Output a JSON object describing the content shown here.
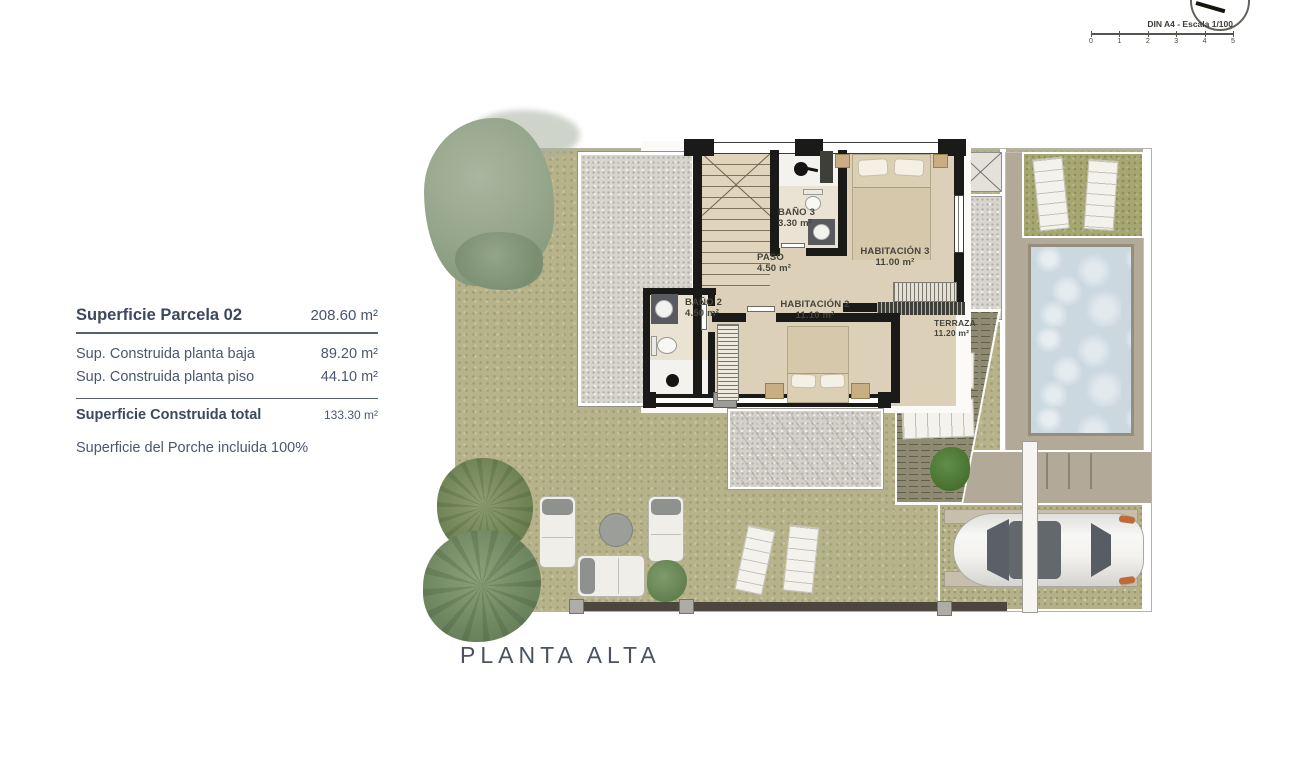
{
  "header": {
    "scale_label": "DIN A4 - Escala 1/100",
    "scale_ticks": [
      "0",
      "1",
      "2",
      "3",
      "4",
      "5"
    ]
  },
  "info_panel": {
    "title": {
      "label": "Superficie Parcela 02",
      "value": "208.60 m²"
    },
    "rows": [
      {
        "label": "Sup. Construida planta baja",
        "value": "89.20 m²"
      },
      {
        "label": "Sup. Construida planta piso",
        "value": "44.10 m²"
      }
    ],
    "total": {
      "label": "Superficie Construida total",
      "value": "133.30 m²"
    },
    "note": "Superficie del Porche incluida 100%"
  },
  "plan": {
    "title": "PLANTA ALTA",
    "rooms": [
      {
        "name": "BAÑO 3",
        "area": "3.30 m²"
      },
      {
        "name": "PASO",
        "area": "4.50 m²"
      },
      {
        "name": "HABITACIÓN 3",
        "area": "11.00 m²"
      },
      {
        "name": "BAÑO 2",
        "area": "4.50 m²"
      },
      {
        "name": "HABITACIÓN 2",
        "area": "11.10 m²"
      },
      {
        "name": "TERRAZA",
        "area": "11.20 m²"
      }
    ]
  },
  "colors": {
    "garden_green": "#b6b28a",
    "grass_olive": "#a6a671",
    "pool_blue": "#cbd8e0",
    "deck_taupe": "#b2a998",
    "terrace_olive": "#8f8b72",
    "floor_beige": "#dcd0b9",
    "wall_black": "#1a1a19",
    "text_slate": "#45526a",
    "accent_orange": "#c06a38"
  }
}
